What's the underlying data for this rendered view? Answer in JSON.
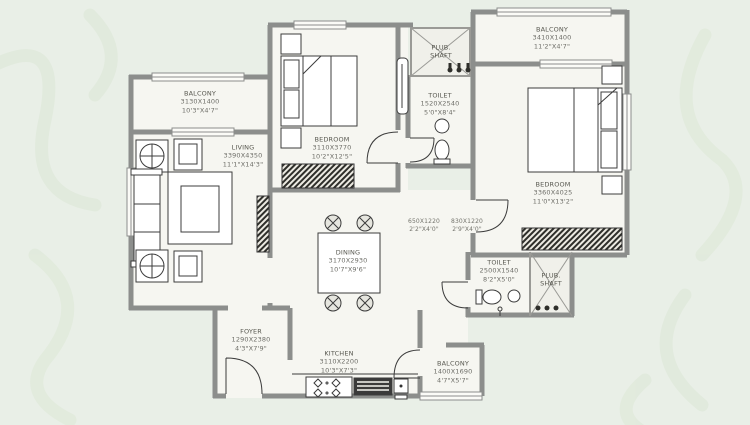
{
  "colors": {
    "background": "#e9efe7",
    "floor": "#f6f6f1",
    "wall": "#8c8e8c",
    "line": "#3c3c3c",
    "watermark": "#dce7d6"
  },
  "rooms": {
    "balcony_tl": {
      "name": "BALCONY",
      "mm": "3130X1400",
      "ft": "10'3\"X4'7\""
    },
    "living": {
      "name": "LIVING",
      "mm": "3390X4350",
      "ft": "11'1\"X14'3\""
    },
    "bedroom1": {
      "name": "BEDROOM",
      "mm": "3110X3770",
      "ft": "10'2\"X12'5\""
    },
    "plub_top": {
      "name": "PLUB.",
      "name2": "SHAFT"
    },
    "toilet_top": {
      "name": "TOILET",
      "mm": "1520X2540",
      "ft": "5'0\"X8'4\""
    },
    "balcony_tr": {
      "name": "BALCONY",
      "mm": "3410X1400",
      "ft": "11'2\"X4'7\""
    },
    "bedroom2": {
      "name": "BEDROOM",
      "mm": "3360X4025",
      "ft": "11'0\"X13'2\""
    },
    "passage_a": {
      "mm": "650X1220",
      "ft": "2'2\"X4'0\""
    },
    "passage_b": {
      "mm": "830X1220",
      "ft": "2'9\"X4'0\""
    },
    "dining": {
      "name": "DINING",
      "mm": "3170X2930",
      "ft": "10'7\"X9'6\""
    },
    "toilet_b": {
      "name": "TOILET",
      "mm": "2500X1540",
      "ft": "8'2\"X5'0\""
    },
    "plub_right": {
      "name": "PLUB.",
      "name2": "SHAFT"
    },
    "foyer": {
      "name": "FOYER",
      "mm": "1290X2380",
      "ft": "4'3\"X7'9\""
    },
    "kitchen": {
      "name": "KITCHEN",
      "mm": "3110X2200",
      "ft": "10'3\"X7'3\""
    },
    "balcony_b": {
      "name": "BALCONY",
      "mm": "1400X1690",
      "ft": "4'7\"X5'7\""
    }
  }
}
